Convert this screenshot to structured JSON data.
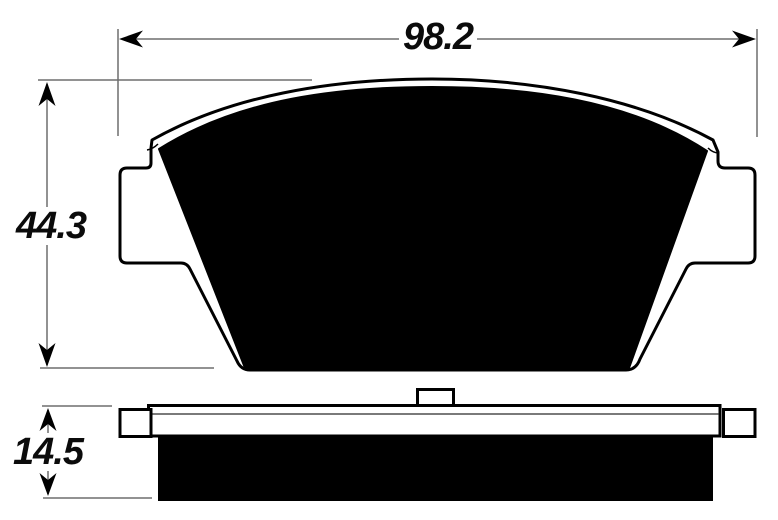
{
  "drawing": {
    "type": "brake-pad-technical-drawing",
    "dimensions": {
      "width": {
        "label": "98.2"
      },
      "height": {
        "label": "44.3"
      },
      "thickness": {
        "label": "14.5"
      }
    },
    "colors": {
      "ink": "#000000",
      "dimension_line": "#6e6e6e",
      "background": "#ffffff"
    }
  }
}
